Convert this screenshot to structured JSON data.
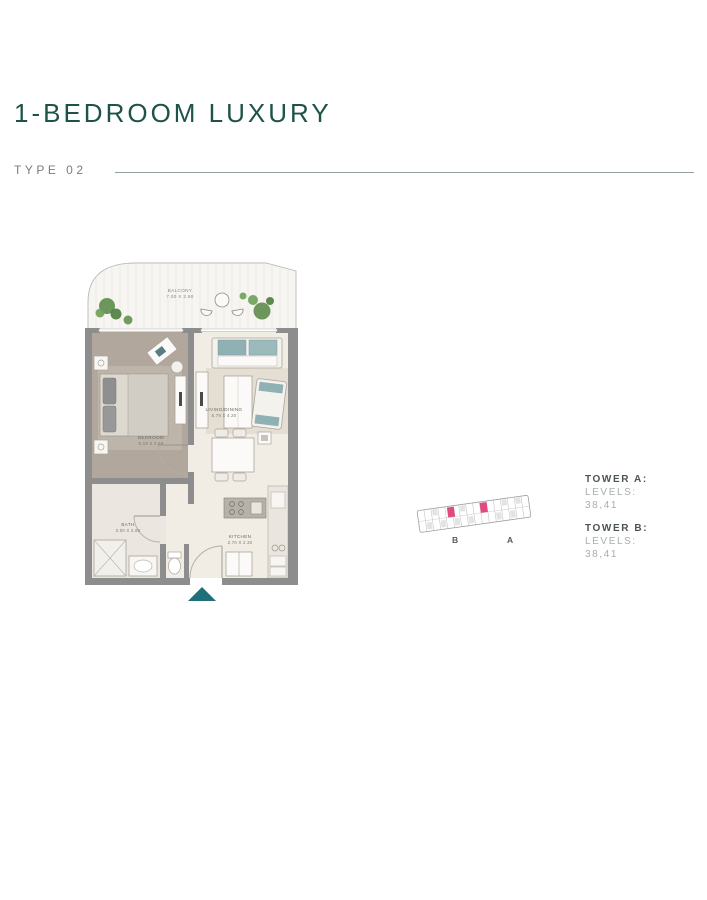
{
  "page": {
    "title": "1-BEDROOM LUXURY",
    "type_label": "TYPE 02"
  },
  "floor_plan": {
    "balcony": {
      "name": "BALCONY",
      "dims": "7.00 X 2.60"
    },
    "bedroom": {
      "name": "BEDROOM",
      "dims": "5.19 X 3.69"
    },
    "living_dining": {
      "name": "LIVING/DINING",
      "dims": "5.79 X 4.20"
    },
    "bath": {
      "name": "BATH",
      "dims": "3.00 X 2.60"
    },
    "kitchen": {
      "name": "KITCHEN",
      "dims": "2.70 X 2.30"
    }
  },
  "key_plan": {
    "tower_b_label": "B",
    "tower_a_label": "A",
    "highlight_color": "#e04a80"
  },
  "towers": {
    "a": {
      "name": "TOWER A:",
      "levels_label": "LEVELS:",
      "levels_value": "38,41"
    },
    "b": {
      "name": "TOWER B:",
      "levels_label": "LEVELS:",
      "levels_value": "38,41"
    }
  },
  "colors": {
    "accent_teal": "#1d5349",
    "entrance_arrow": "#20707a"
  }
}
